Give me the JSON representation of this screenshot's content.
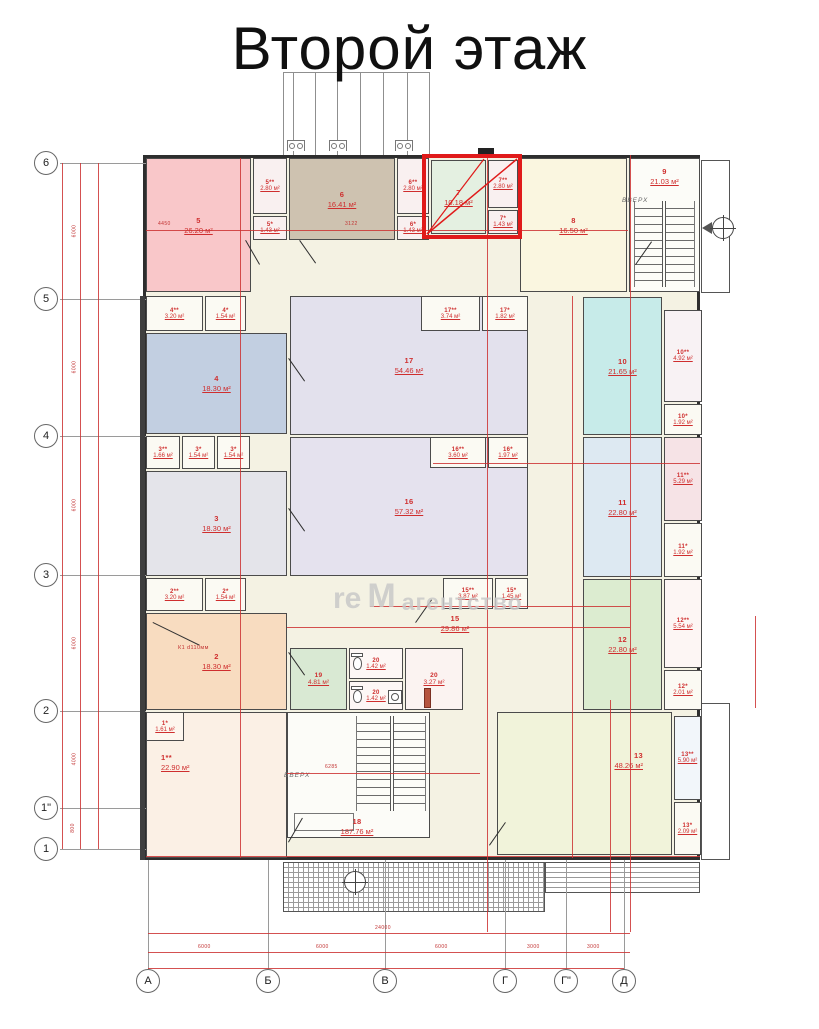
{
  "title": "Второй этаж",
  "watermark": {
    "part1": "re",
    "logo": "M",
    "part2": "агентство"
  },
  "labels": {
    "up": "ВВЕРХ",
    "k1": "К1 d110мм"
  },
  "axes": {
    "left": [
      "6",
      "5",
      "4",
      "3",
      "2",
      "1\"",
      "1"
    ],
    "bottom": [
      "А",
      "Б",
      "В",
      "Г",
      "Г\"",
      "Д"
    ]
  },
  "dims": {
    "left": [
      "6000",
      "6000",
      "6000",
      "6000",
      "4000",
      "800"
    ],
    "bottom": [
      "6000",
      "6000",
      "6000",
      "3000",
      "3000"
    ],
    "bottom_total": "24000",
    "inplan": [
      "4450",
      "3122",
      "6285"
    ]
  },
  "colors": {
    "highlight_red": "#e01a1a",
    "dimension_red": "#cc3232",
    "label_red": "#cf2e2e"
  },
  "rooms": {
    "r5": {
      "num": "5",
      "area": "26.20 м²"
    },
    "r5s2": {
      "num": "5**",
      "area": "2.80 м²"
    },
    "r5s1": {
      "num": "5*",
      "area": "1.43 м²"
    },
    "r6": {
      "num": "6",
      "area": "16.41 м²"
    },
    "r6s2": {
      "num": "6**",
      "area": "2.80 м²"
    },
    "r6s1": {
      "num": "6*",
      "area": "1.43 м²"
    },
    "r7": {
      "num": "7",
      "area": "10.18 м²"
    },
    "r7s2": {
      "num": "7**",
      "area": "2.80 м²"
    },
    "r7s1": {
      "num": "7*",
      "area": "1.43 м²"
    },
    "r8": {
      "num": "8",
      "area": "16.50 м²"
    },
    "r9": {
      "num": "9",
      "area": "21.03 м²"
    },
    "r4s2": {
      "num": "4**",
      "area": "3.20 м²"
    },
    "r4s1": {
      "num": "4*",
      "area": "1.54 м²"
    },
    "r4": {
      "num": "4",
      "area": "18.30 м²"
    },
    "r3s2": {
      "num": "3**",
      "area": "1.66 м²"
    },
    "r3s1a": {
      "num": "3*",
      "area": "1.54 м²"
    },
    "r3s1b": {
      "num": "3*",
      "area": "1.54 м²"
    },
    "r3": {
      "num": "3",
      "area": "18.30 м²"
    },
    "r2s2": {
      "num": "2**",
      "area": "3.20 м²"
    },
    "r2s1": {
      "num": "2*",
      "area": "1.54 м²"
    },
    "r2": {
      "num": "2",
      "area": "18.30 м²"
    },
    "r1s1": {
      "num": "1*",
      "area": "1.61 м²"
    },
    "r1s2": {
      "num": "1**",
      "area": "22.90 м²"
    },
    "r17": {
      "num": "17",
      "area": "54.46 м²"
    },
    "r17s2": {
      "num": "17**",
      "area": "3.74 м²"
    },
    "r17s1": {
      "num": "17*",
      "area": "1.82 м²"
    },
    "r16": {
      "num": "16",
      "area": "57.32 м²"
    },
    "r16s2": {
      "num": "16**",
      "area": "3.60 м²"
    },
    "r16s1": {
      "num": "16*",
      "area": "1.97 м²"
    },
    "r15": {
      "num": "15",
      "area": "29.86 м²"
    },
    "r15s2": {
      "num": "15**",
      "area": "3.87 м²"
    },
    "r15s1": {
      "num": "15*",
      "area": "1.45 м²"
    },
    "r10": {
      "num": "10",
      "area": "21.65 м²"
    },
    "r10s2": {
      "num": "10**",
      "area": "4.92 м²"
    },
    "r10s1": {
      "num": "10*",
      "area": "1.92 м²"
    },
    "r11": {
      "num": "11",
      "area": "22.80 м²"
    },
    "r11s2": {
      "num": "11**",
      "area": "5.29 м²"
    },
    "r11s1": {
      "num": "11*",
      "area": "1.92 м²"
    },
    "r12": {
      "num": "12",
      "area": "22.80 м²"
    },
    "r12s2": {
      "num": "12**",
      "area": "5.54 м²"
    },
    "r12s1": {
      "num": "12*",
      "area": "2.01 м²"
    },
    "r13": {
      "num": "13",
      "area": "48.26 м²"
    },
    "r13s2": {
      "num": "13**",
      "area": "5.90 м²"
    },
    "r13s1": {
      "num": "13*",
      "area": "2.09 м²"
    },
    "r18": {
      "num": "18",
      "area": "187.76 м²"
    },
    "r19": {
      "num": "19",
      "area": "4.81 м²"
    },
    "r20a": {
      "num": "20",
      "area": "1.42 м²"
    },
    "r20b": {
      "num": "20",
      "area": "1.42 м²"
    },
    "r20c": {
      "num": "20",
      "area": "3.27 м²"
    }
  }
}
